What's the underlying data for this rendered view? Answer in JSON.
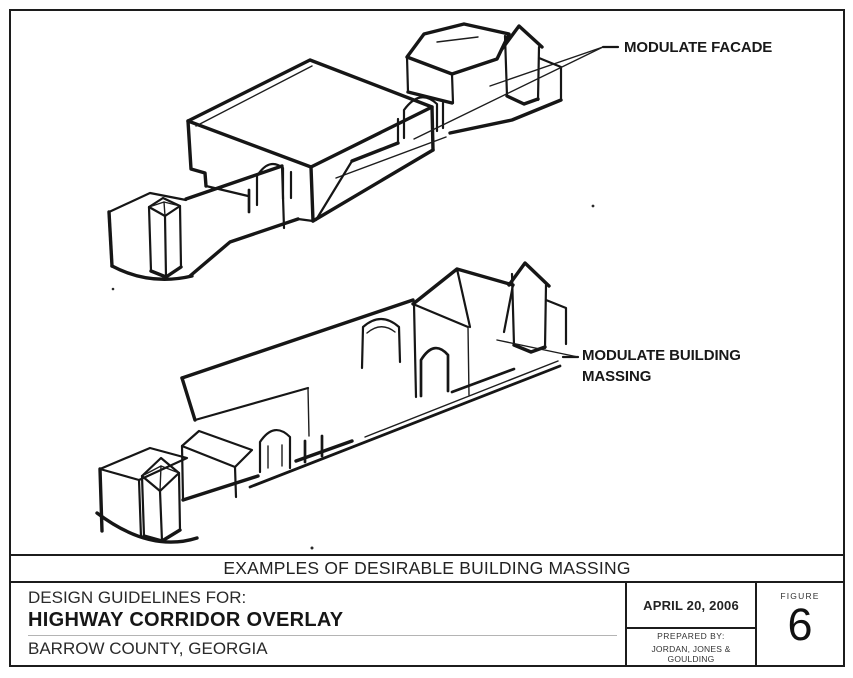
{
  "drawing": {
    "labels": {
      "facade": "MODULATE FACADE",
      "massing": "MODULATE BUILDING MASSING"
    },
    "caption": "EXAMPLES OF DESIRABLE BUILDING MASSING"
  },
  "title_block": {
    "line1": "DESIGN GUIDELINES FOR:",
    "line2": "HIGHWAY CORRIDOR OVERLAY",
    "line3": "BARROW COUNTY, GEORGIA",
    "date": "APRIL 20, 2006",
    "prepared_by_label": "PREPARED BY:",
    "prepared_by": "JORDAN, JONES & GOULDING",
    "figure_label": "FIGURE",
    "figure_number": "6"
  },
  "colors": {
    "ink": "#161616",
    "paper": "#ffffff",
    "rule_gray": "#b4b4b4"
  }
}
